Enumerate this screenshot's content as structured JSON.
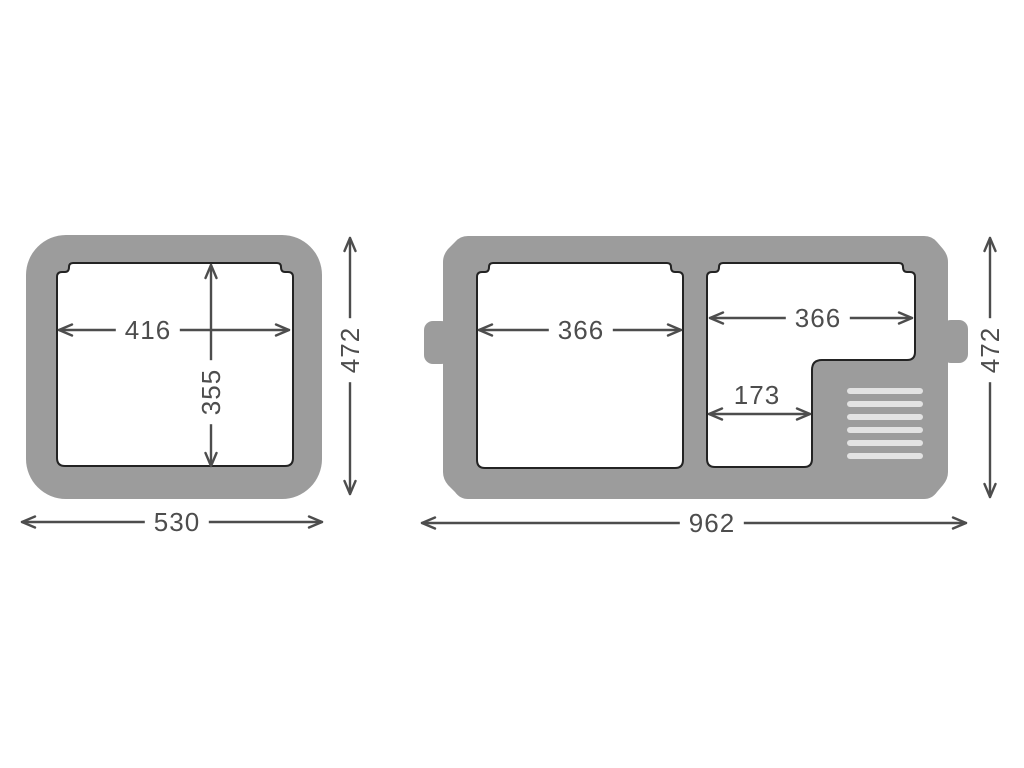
{
  "colors": {
    "background": "#ffffff",
    "body_gray": "#9c9c9c",
    "liner_fill": "#ffffff",
    "liner_outline": "#232323",
    "vent_slat": "#e2e2e2",
    "dimension_line": "#4d4d4d",
    "dimension_text": "#4d4d4d"
  },
  "left_unit": {
    "inner_width_mm": "416",
    "inner_depth_mm": "355",
    "overall_depth_mm": "472",
    "overall_width_mm": "530"
  },
  "right_unit": {
    "left_compartment_width_mm": "366",
    "right_compartment_width_mm": "366",
    "compartment_step_width_mm": "173",
    "overall_depth_mm": "472",
    "overall_width_mm": "962"
  }
}
